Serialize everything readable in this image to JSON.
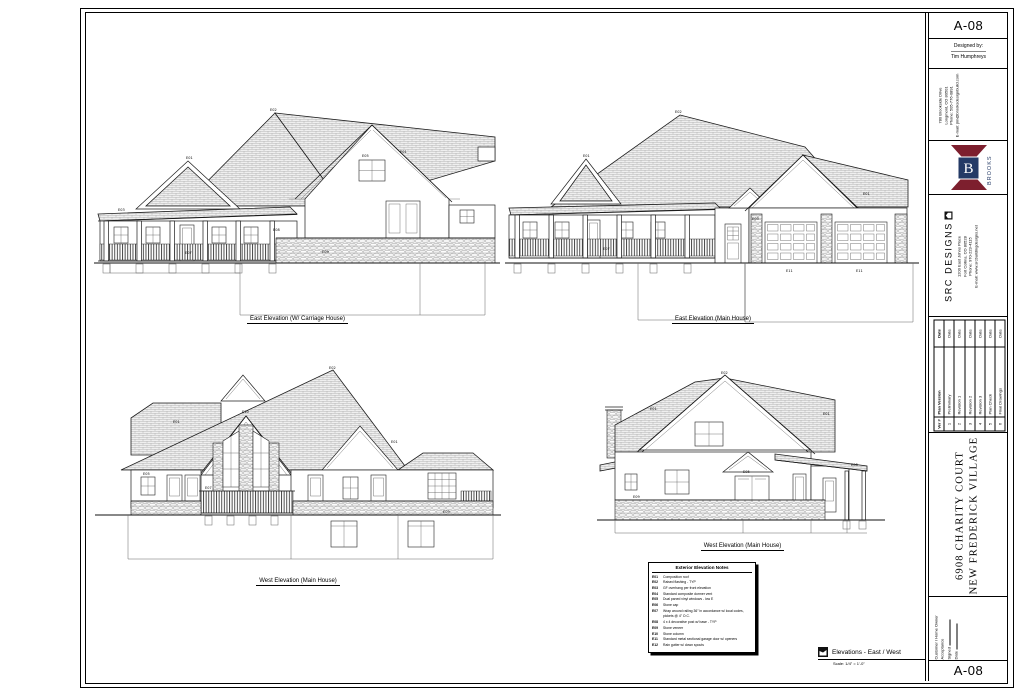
{
  "sheet": {
    "number": "A-08",
    "designed_by_label": "Designed by:",
    "designer": "Tim Humphreys",
    "builder": {
      "lines": [
        "780 Brookside Drive",
        "Longmont, CO 80501",
        "Phone: 505-776-0891",
        "E-mail: jim@brooksdesignbuild.com"
      ]
    },
    "logo": {
      "monogram": "B",
      "text": "BROOKS",
      "maroon": "#7d1f2e",
      "navy": "#243a66"
    },
    "firm": {
      "name": "SRC DESIGNS",
      "lines": [
        "1200 East Johns Place",
        "Fort Collins, CO 80528",
        "Phone: 970-223-4115",
        "E-mail: www.srcbuildingdesigns.net"
      ]
    },
    "revisions": {
      "headers": [
        "Ver #",
        "Plan Version",
        "Date"
      ],
      "rows": [
        {
          "ver": "1",
          "name": "Preliminary",
          "date": "Date"
        },
        {
          "ver": "2",
          "name": "Revision 1",
          "date": "Date"
        },
        {
          "ver": "3",
          "name": "Revision 2",
          "date": "Date"
        },
        {
          "ver": "4",
          "name": "Revision 3",
          "date": "Date"
        },
        {
          "ver": "5",
          "name": "Plan Check",
          "date": "Date"
        },
        {
          "ver": "6",
          "name": "Final Drawings",
          "date": "Date"
        }
      ]
    },
    "project": {
      "line1": "6908 CHARITY COURT",
      "line2": "NEW FREDERICK VILLAGE"
    },
    "acceptance": {
      "title": "Customer / Home Owner Acceptance",
      "signed_label": "Signed",
      "date_label": "Date"
    },
    "drawing_title": {
      "title": "Elevations - East / West",
      "scale": "Scale: 1/4\" = 1'-0\""
    }
  },
  "elevations": [
    {
      "id": "east-carriage",
      "label": "East Elevation (W/ Carriage House)"
    },
    {
      "id": "east-main",
      "label": "East Elevation (Main House)"
    },
    {
      "id": "west-main-left",
      "label": "West Elevation (Main House)"
    },
    {
      "id": "west-main-right",
      "label": "West Elevation (Main House)"
    }
  ],
  "notes": {
    "title": "Exterior Elevation Notes",
    "items": [
      {
        "code": "E01",
        "text": "Composition roof"
      },
      {
        "code": "E02",
        "text": "Raised flashing - TYP"
      },
      {
        "code": "E03",
        "text": "GF overhang per front elevation"
      },
      {
        "code": "E04",
        "text": "Standard composite dormer vent"
      },
      {
        "code": "E05",
        "text": "Dual paned vinyl windows - low E"
      },
      {
        "code": "E06",
        "text": "Stone cap"
      },
      {
        "code": "E07",
        "text": "Wrap around railing 36\" in accordance w/ local codes, pickets @ 4\" O.C."
      },
      {
        "code": "E08",
        "text": "4 x 4 decorative post w/ base - TYP"
      },
      {
        "code": "E09",
        "text": "Stone veneer"
      },
      {
        "code": "E10",
        "text": "Stone column"
      },
      {
        "code": "E11",
        "text": "Standard metal sectional garage door w/ openers"
      },
      {
        "code": "E12",
        "text": "Rain gutter w/ down spouts"
      }
    ]
  }
}
